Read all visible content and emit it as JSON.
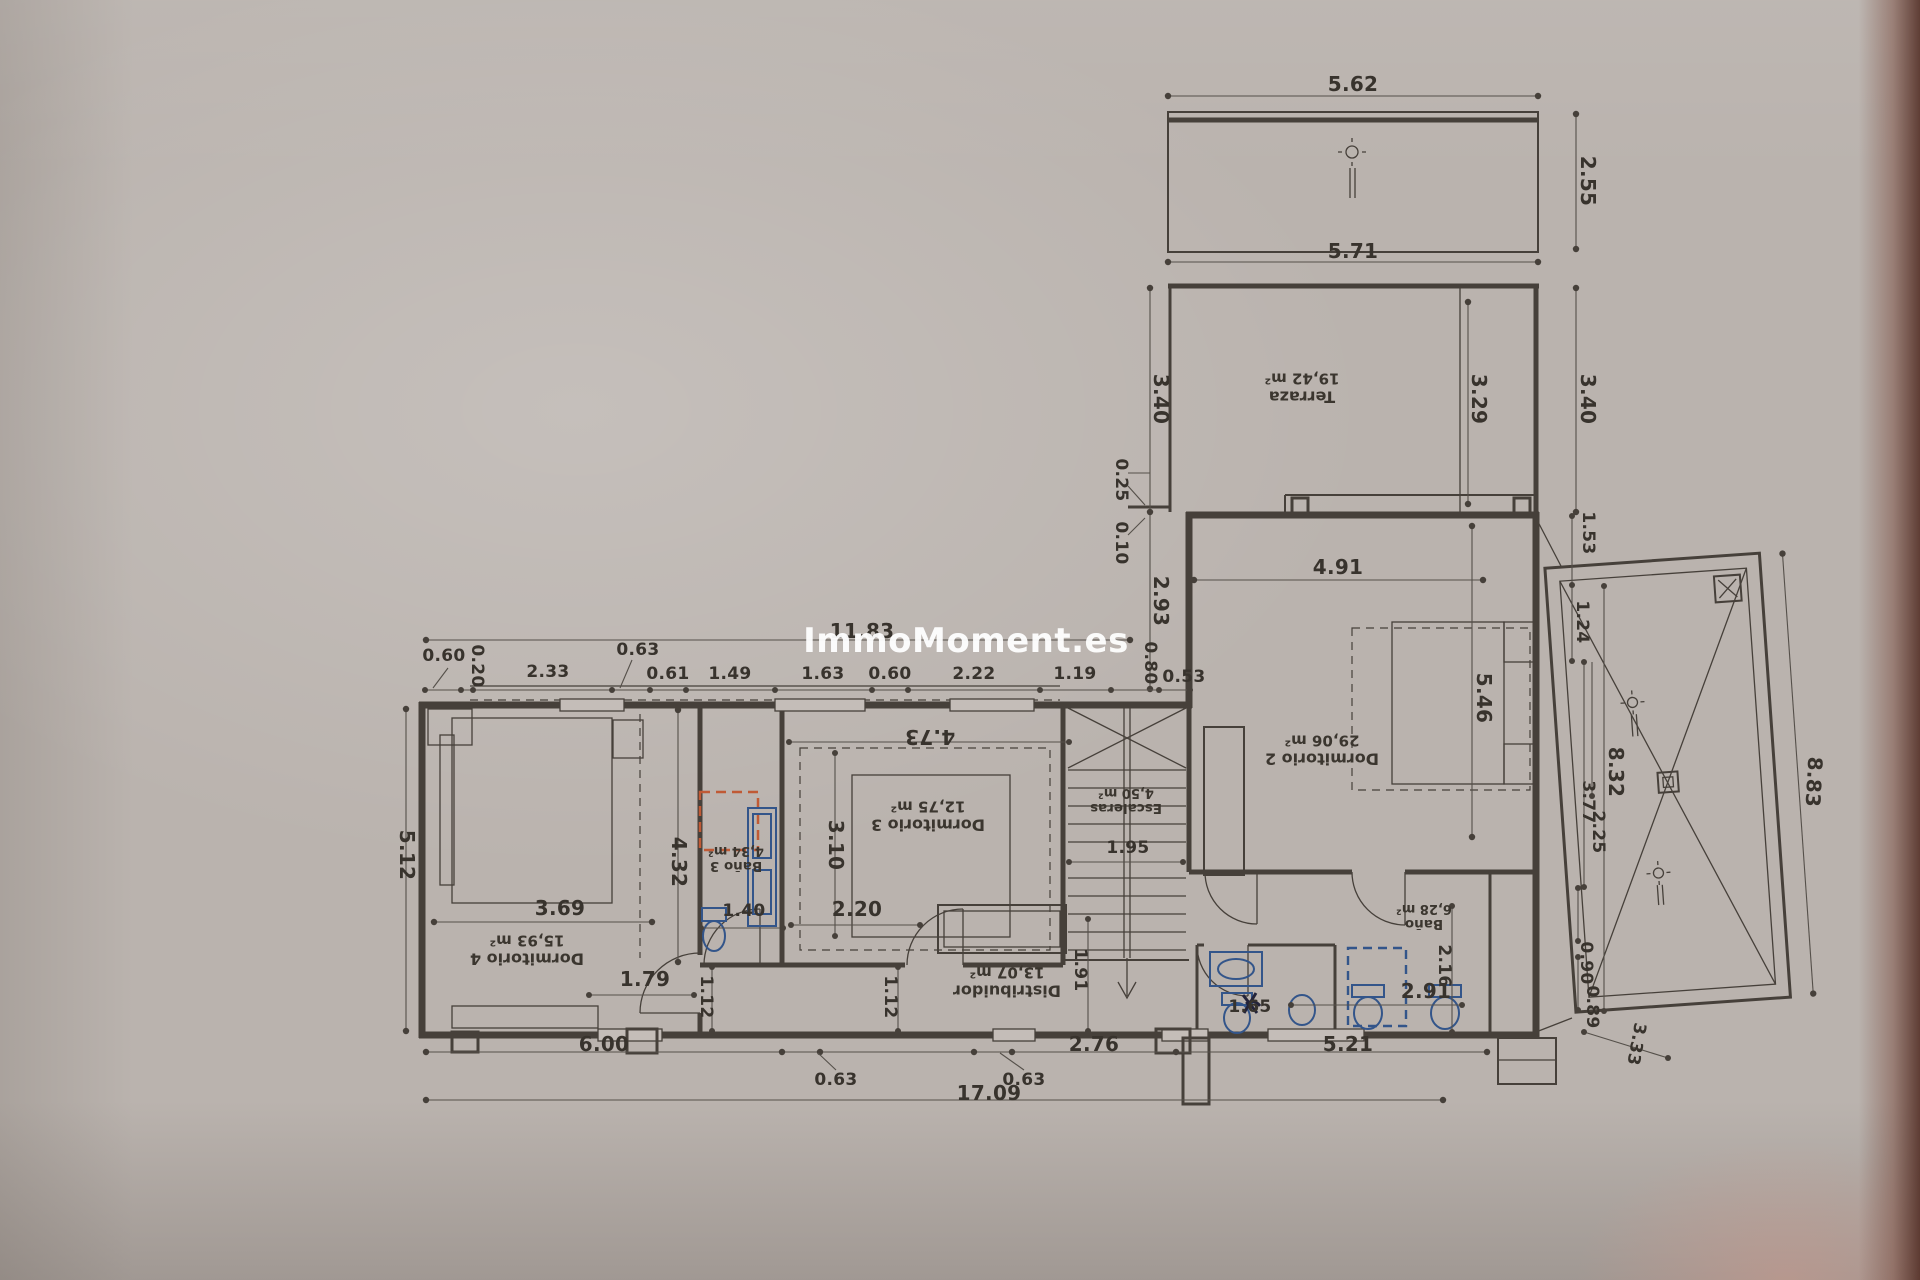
{
  "watermark": "ImmoMoment.es",
  "colors": {
    "paper": "#bab3ae",
    "ink": "#46403a",
    "fixture_blue": "#33558a",
    "shower_orange": "#c05a35",
    "watermark": "#ffffff"
  },
  "rooms": [
    {
      "name": "Terraza",
      "area": "19,42 m²"
    },
    {
      "name": "Dormitorio 2",
      "area": "29,06 m²"
    },
    {
      "name": "Dormitorio 3",
      "area": "12,75 m²"
    },
    {
      "name": "Dormitorio 4",
      "area": "15,93 m²"
    },
    {
      "name": "Baño 3",
      "area": "4,34 m²"
    },
    {
      "name": "Baño",
      "area": "6,28 m²"
    },
    {
      "name": "Escaleras",
      "area": "4,50 m²"
    },
    {
      "name": "Distribuidor",
      "area": "13,07 m²"
    }
  ],
  "dims": {
    "pergola_width": "5.62",
    "pergola_height": "2.55",
    "terrace_width": "5.71",
    "terrace_height_left": "3.40",
    "terrace_height_inner": "3.29",
    "terrace_height_right": "3.40",
    "offset_a": "0.25",
    "offset_b": "0.10",
    "stair_side": "2.93",
    "dorm2_top_width": "4.91",
    "parapet": "1.53",
    "pool_step1": "1.24",
    "wing_total_top": "11.83",
    "row1": "0.60",
    "row2": "0.20",
    "row3": "2.33",
    "row4": "0.63",
    "row5": "0.61",
    "row6": "1.49",
    "row7": "1.63",
    "row8": "0.60",
    "row9": "2.22",
    "row10": "1.19",
    "row11": "0.80",
    "row12": "0.53",
    "dorm2_bed": "5.46",
    "pool_right": "8.83",
    "pool_length": "8.32",
    "pool_a": "3.77",
    "pool_b": "2.25",
    "pool_c": "0.90",
    "pool_d": "0.89",
    "pool_e": "3.33",
    "left_height": "5.12",
    "dorm4_width": "3.69",
    "dorm4_side": "4.32",
    "bath3_width": "1.40",
    "dorm3_side": "3.10",
    "dorm3_door": "2.20",
    "dorm3_top": "4.73",
    "stair_width": "1.95",
    "dorm4_door": "1.79",
    "hall_a": "1.12",
    "hall_b": "1.12",
    "hall_c": "1.91",
    "bath_depth": "2.16",
    "bath_width": "2.91",
    "aseo_width": "1.65",
    "bottom_a": "6.00",
    "bottom_b": "2.76",
    "bottom_c": "5.21",
    "bottom_w1": "0.63",
    "bottom_w2": "0.63",
    "bottom_total": "17.09"
  }
}
